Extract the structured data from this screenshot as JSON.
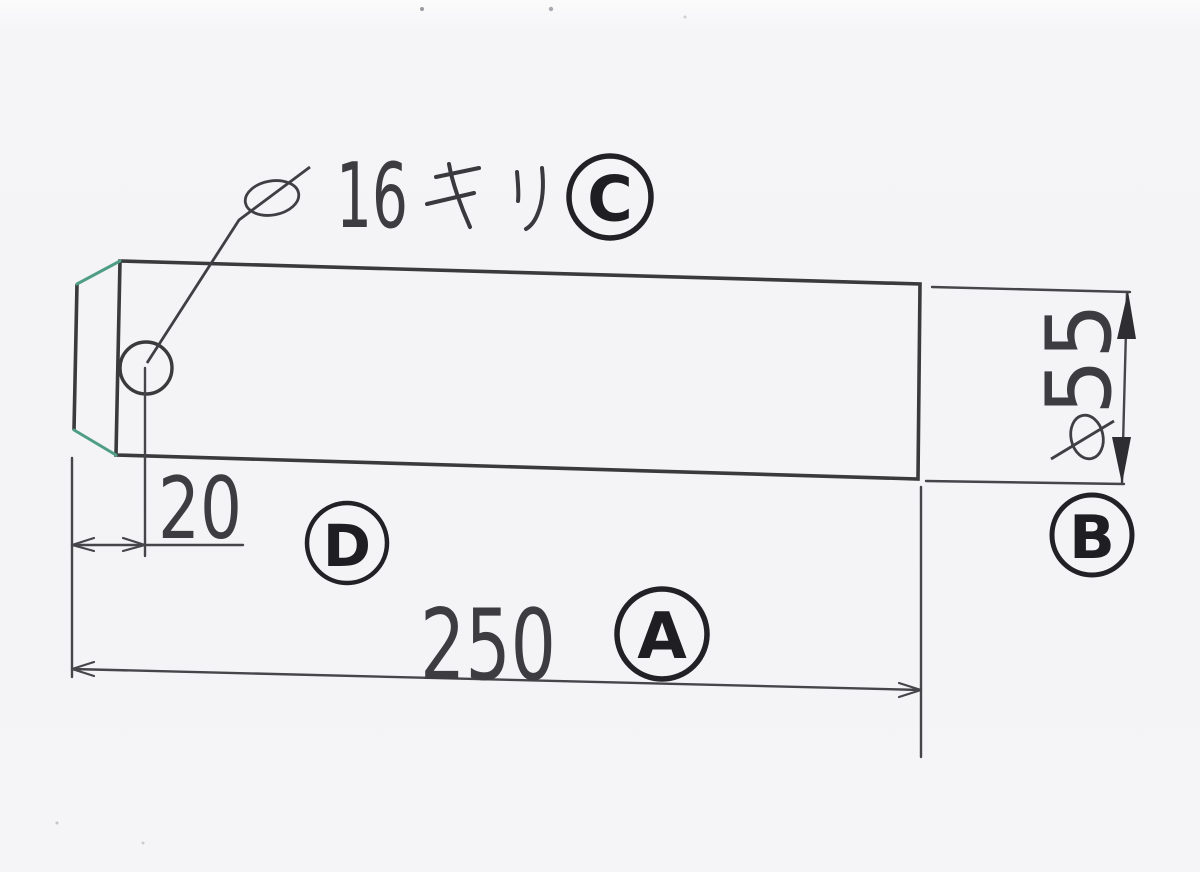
{
  "document": {
    "kind": "scanned technical drawing",
    "subject": "round steel bar with chamfered end and one drilled cross hole",
    "paper_color": "#f4f4f6",
    "line_color": "#3a3a3d",
    "chamfer_highlight_color": "#4f9e83",
    "label_ink_color": "#1f1f23"
  },
  "annotations": {
    "hole_note": {
      "diameter_symbol": "φ",
      "value": "16",
      "suffix_katakana": "キリ",
      "full_text": "φ16キリ",
      "label": "C"
    },
    "hole_offset_dimension": {
      "value": "20",
      "label": "D"
    },
    "overall_length_dimension": {
      "value": "250",
      "label": "A"
    },
    "bar_diameter_dimension": {
      "diameter_symbol": "φ",
      "value": "55",
      "full_text": "φ55",
      "label": "B"
    }
  }
}
